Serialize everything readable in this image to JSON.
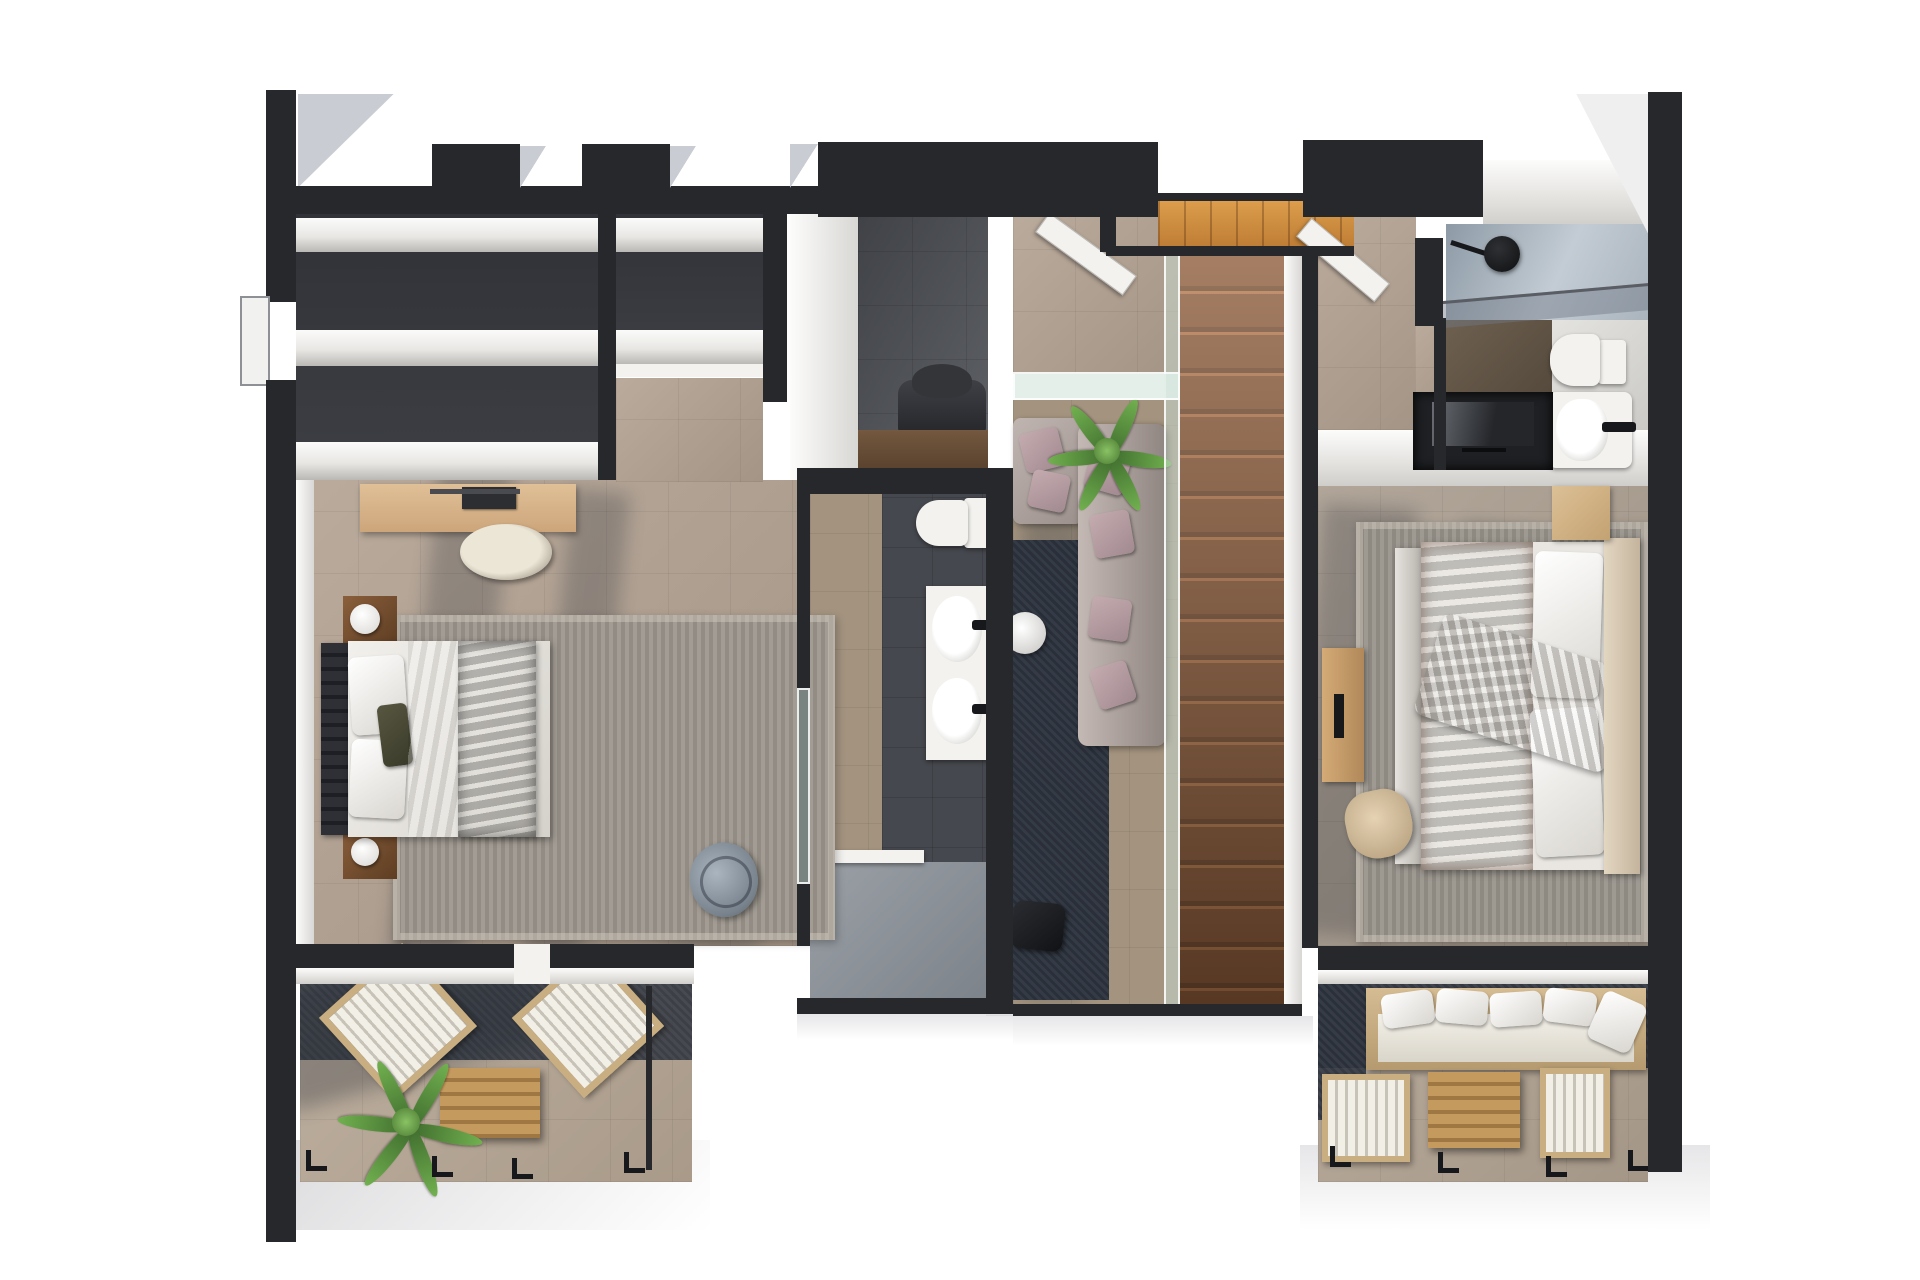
{
  "scene": {
    "type": "3d-floorplan-render",
    "view": "top-down dollhouse view, upper floor",
    "background": "#ffffff",
    "title": "Upper floor plan render"
  },
  "palette": {
    "wall_charcoal": "#26282c",
    "white_wall_face": "#f4f3f1",
    "floor_beige": "#b2a191",
    "floor_beige_dark": "#a3937f",
    "slate_tile": "#55585e",
    "closet_interior": "#34363b",
    "navy_rug": "#2d333e",
    "stair_wood": "#8c5a38",
    "landing_wood": "#cd8c3e",
    "desk_wood": "#d7b68e",
    "duvet_orange": "#b75a1e",
    "olive_blanket": "#45452f",
    "mauve_pillow": "#b49aa0",
    "glass": "#cde0d6",
    "rug_grey": "#9b958c",
    "outdoor_wood": "#c9a briefly"
  },
  "rooms": [
    {
      "id": "bedroom-left",
      "label": "Left bedroom with desk, double bed and wardrobe wall",
      "furniture": [
        "wardrobe-shelves",
        "desk",
        "laptop",
        "desk-chair",
        "double-bed",
        "olive-blanket",
        "nightstand-with-lamp x2",
        "grey-rug",
        "beanbag-chair"
      ]
    },
    {
      "id": "walk-in-closet",
      "label": "Wardrobe shelving along top wall"
    },
    {
      "id": "dressing-nook",
      "label": "Dressing nook with armchair and console"
    },
    {
      "id": "ensuite-bathroom",
      "label": "En-suite bathroom with toilet, double vanity and shower",
      "furniture": [
        "toilet",
        "double-sink-vanity",
        "walk-in-shower"
      ]
    },
    {
      "id": "hallway-void",
      "label": "Hallway with glass-railed void overlooking living room below",
      "furniture": [
        "sectional-sofa",
        "mauve-pillows",
        "potted-palm",
        "navy-rug",
        "round-side-table",
        "bench"
      ]
    },
    {
      "id": "staircase",
      "label": "Wooden staircase with top landing and glass balustrade"
    },
    {
      "id": "bathroom-top-right",
      "label": "Second bathroom with shower, toilet and washbasin",
      "furniture": [
        "shower-head",
        "glass-screen",
        "toilet",
        "washbasin"
      ]
    },
    {
      "id": "bedroom-right",
      "label": "Right bedroom with orange bed, TV niche and terrace access",
      "furniture": [
        "double-bed-orange",
        "grey-throw",
        "headboard",
        "nightstand",
        "tv-niche",
        "sideboard",
        "armchair",
        "grey-rug"
      ]
    },
    {
      "id": "terrace-left",
      "label": "Lower-left terrace with two sun loungers, table and palm plant",
      "furniture": [
        "sun-lounger x2",
        "slatted-coffee-table",
        "palm-plant",
        "railing"
      ]
    },
    {
      "id": "terrace-right",
      "label": "Lower-right terrace with outdoor sofa, loungers and table",
      "furniture": [
        "outdoor-sofa",
        "sun-lounger",
        "slatted-coffee-table",
        "side-chair",
        "railing"
      ]
    }
  ]
}
